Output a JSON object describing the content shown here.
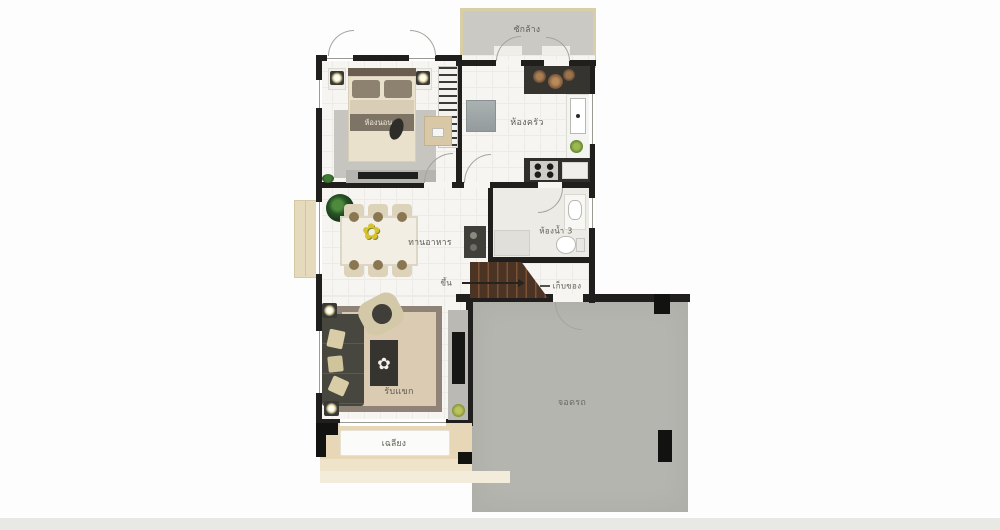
{
  "plan_type": "single-storey house floor plan (first floor)",
  "colors": {
    "wall": "#201f1d",
    "floor": "#f6f5f2",
    "label_text": "#5f5b52",
    "laundry_fill": "#cac9c3",
    "laundry_border": "#d8cfa6",
    "garage_fill": "#b4b5ae",
    "porch_fill": "#e8d7b6",
    "porch_fill_light": "#efe3ca",
    "stairs_fill": "#4c3425",
    "stairs_tread": "#7c5236",
    "bed_body": "#eae1cc",
    "bed_band": "#7d7466",
    "rug_gray": "#c6c5bf",
    "sofa_dark": "#47463f",
    "living_rug": "#dacbb2",
    "living_rug_border": "#8e8376",
    "table_dark": "#35342f",
    "chair_tan": "#ddd3ba",
    "flower_yellow": "#d9c22f",
    "plant_green": "#2d5c2b"
  },
  "rooms": {
    "laundry": {
      "label": "ซักล้าง"
    },
    "bedroom4": {
      "label": "ห้องนอน 4"
    },
    "kitchen": {
      "label": "ห้องครัว"
    },
    "bathroom3": {
      "label": "ห้องน้ำ 3"
    },
    "dining": {
      "label": "ทานอาหาร"
    },
    "stairs_up": {
      "label": "ขึ้น"
    },
    "storage": {
      "label": "เก็บของ"
    },
    "living": {
      "label": "รับแขก"
    },
    "porch": {
      "label": "เฉลียง"
    },
    "carport": {
      "label": "จอดรถ"
    }
  },
  "icons": {
    "dining_centerpiece": "flower-icon",
    "coffee_table_decor": "flower-icon",
    "stairs_direction": "right-arrow-icon"
  }
}
